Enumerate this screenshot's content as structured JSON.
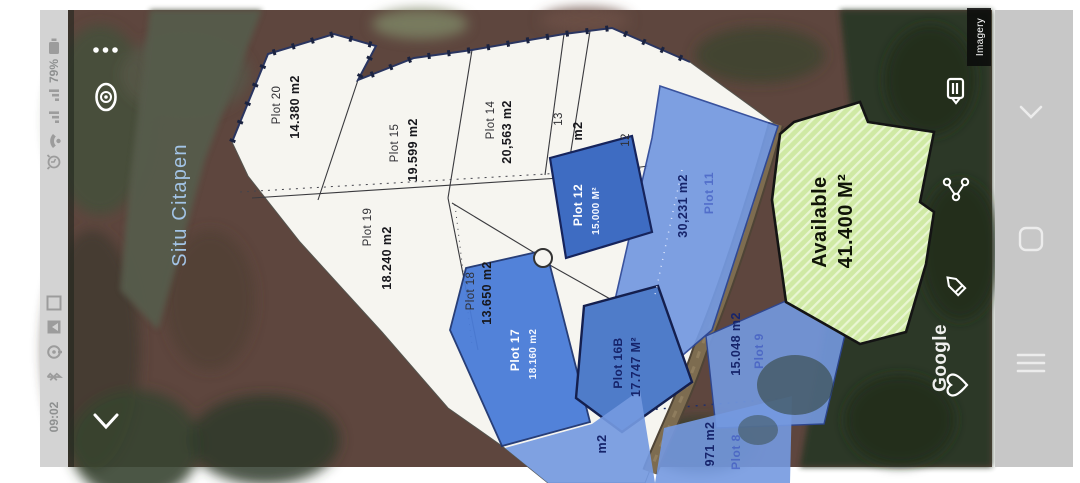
{
  "status_bar": {
    "time": "09:02",
    "battery_percent": "79%",
    "icons": [
      "battery-icon",
      "signal-icon",
      "signal-icon",
      "wifi-icon",
      "alarm-icon",
      "smart-view-icon",
      "gallery-icon",
      "voice-recorder-icon",
      "bluetooth-icon"
    ]
  },
  "nav_bar": {
    "icons": [
      "back-chevron-icon",
      "home-icon",
      "recents-icon"
    ]
  },
  "map": {
    "water_label": "Situ Citapen",
    "attribution": "Google",
    "imagery_label": "Imagery",
    "overlay_icons": [
      "more-options-icon",
      "compass-icon",
      "collapse-chevron-icon",
      "notes-icon",
      "share-icon",
      "edit-icon",
      "favorite-icon"
    ],
    "available": {
      "label": "Available",
      "area": "41.400 M²"
    },
    "plots": {
      "p20": {
        "name": "Plot 20",
        "area": "14.380 m2"
      },
      "p15": {
        "name": "Plot 15",
        "area": "19.599 m2"
      },
      "p14": {
        "name": "Plot 14",
        "area": "20,563 m2"
      },
      "p13": {
        "name": "13",
        "area": "m2"
      },
      "p12s": {
        "name": "12"
      },
      "p19": {
        "name": "Plot 19",
        "area": "18.240 m2"
      },
      "p18": {
        "name": "Plot 18",
        "area": "13.650 m2"
      },
      "p12": {
        "name": "Plot 12",
        "area": "15.000 M²"
      },
      "p11": {
        "name": "Plot 11",
        "area": "30,231 m2"
      },
      "p17": {
        "name": "Plot 17",
        "area": "18.160 m2"
      },
      "p16b": {
        "name": "Plot 16B",
        "area": "17.747 M²"
      },
      "p9": {
        "name": "Plot 9",
        "area": "15.048 m2"
      },
      "p8": {
        "name": "Plot 8",
        "area": "971 m2"
      },
      "partial": {
        "area": "m2"
      }
    }
  },
  "colors": {
    "available_green": "#cfe9a4",
    "plot_blue_dark": "#3e6cc2",
    "plot_blue_mid": "#4f7cc9",
    "plot_blue_light": "#7499e0",
    "land_white": "#f6f5f0",
    "road_brown": "#7d6c50",
    "status_bar_gray": "#d3d3d3",
    "nav_bar_gray": "#c7c7c7"
  }
}
